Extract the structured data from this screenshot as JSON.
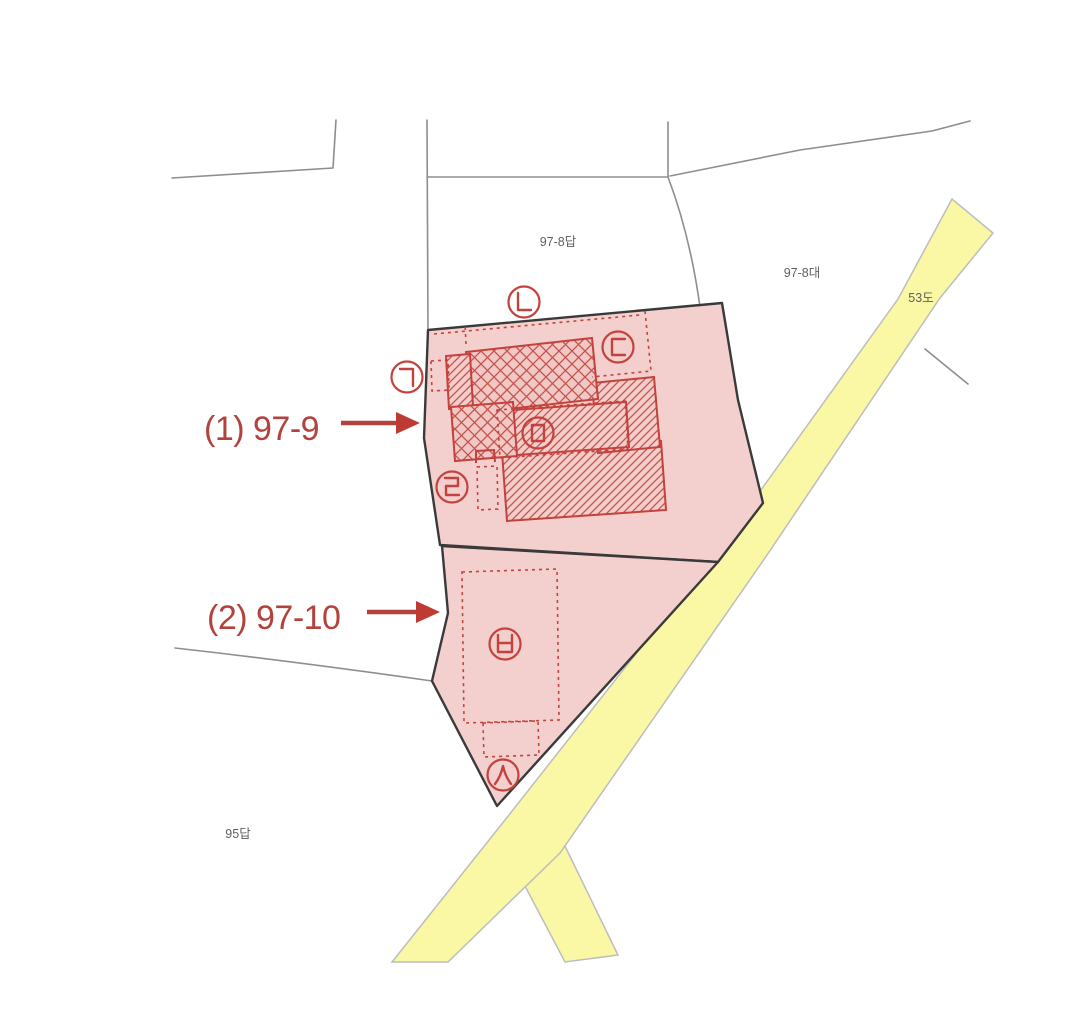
{
  "map": {
    "title": "cadastral-parcel-map",
    "annotations": [
      {
        "label": "(1) 97-9",
        "parcel": "97-9"
      },
      {
        "label": "(2) 97-10",
        "parcel": "97-10"
      }
    ],
    "neighbor_parcel_labels": [
      {
        "text": "97-8답"
      },
      {
        "text": "97-8대"
      },
      {
        "text": "53도"
      },
      {
        "text": "95답"
      }
    ],
    "highlighted_parcels": [
      {
        "name": "97-9",
        "fill": "#f3d0ce"
      },
      {
        "name": "97-10",
        "fill": "#f3d0ce"
      }
    ],
    "circle_markers": [
      {
        "letter": "ㄱ"
      },
      {
        "letter": "ㄴ"
      },
      {
        "letter": "ㄷ"
      },
      {
        "letter": "ㄹ"
      },
      {
        "letter": "ㅁ"
      },
      {
        "letter": "ㅂ"
      },
      {
        "letter": "ㅅ"
      }
    ],
    "colors": {
      "parcel_fill": "#f3d0ce",
      "building_outline_red": "#c4423d",
      "road_fill": "#faf7a5",
      "annotation_red": "#b2423c",
      "parcel_border": "#3a3a3a",
      "boundary_gray": "#8e8e8e"
    }
  }
}
